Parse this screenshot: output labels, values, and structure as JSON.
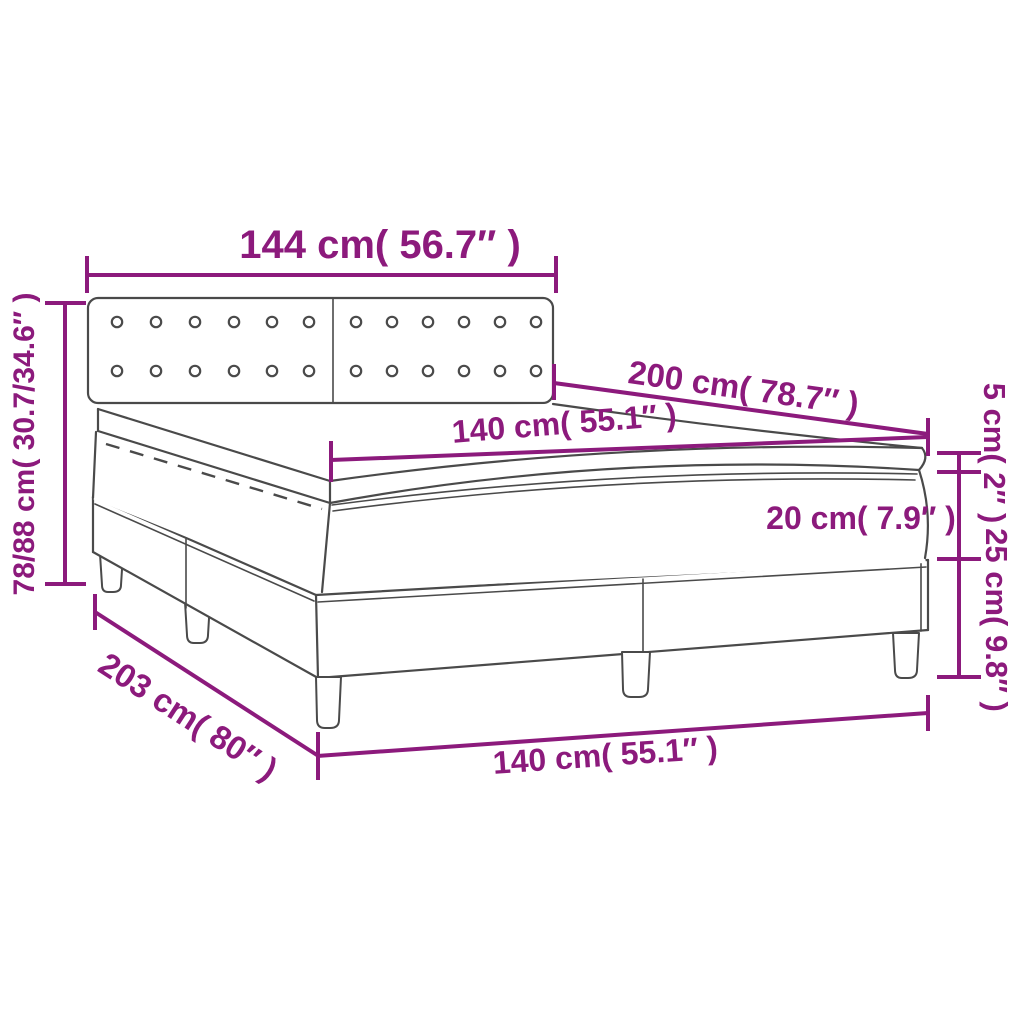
{
  "diagram": {
    "background_color": "#ffffff",
    "annotation_color": "#8c1a7c",
    "linework_color": "#4a4a4a",
    "product": "box spring bed with buttoned headboard, mattress and topper",
    "labels": {
      "headboard_width": "144 cm( 56.7″ )",
      "bed_length": "200 cm( 78.7″ )",
      "mattress_width_top": "140 cm( 55.1″ )",
      "overall_height": "78/88 cm( 30.7/34.6″ )",
      "frame_length": "203 cm( 80″ )",
      "mattress_width_front": "140 cm( 55.1″ )",
      "mattress_thickness": "20 cm( 7.9″ )",
      "topper_thickness": "5 cm( 2″ )",
      "base_height": "25 cm( 9.8″ )"
    }
  }
}
